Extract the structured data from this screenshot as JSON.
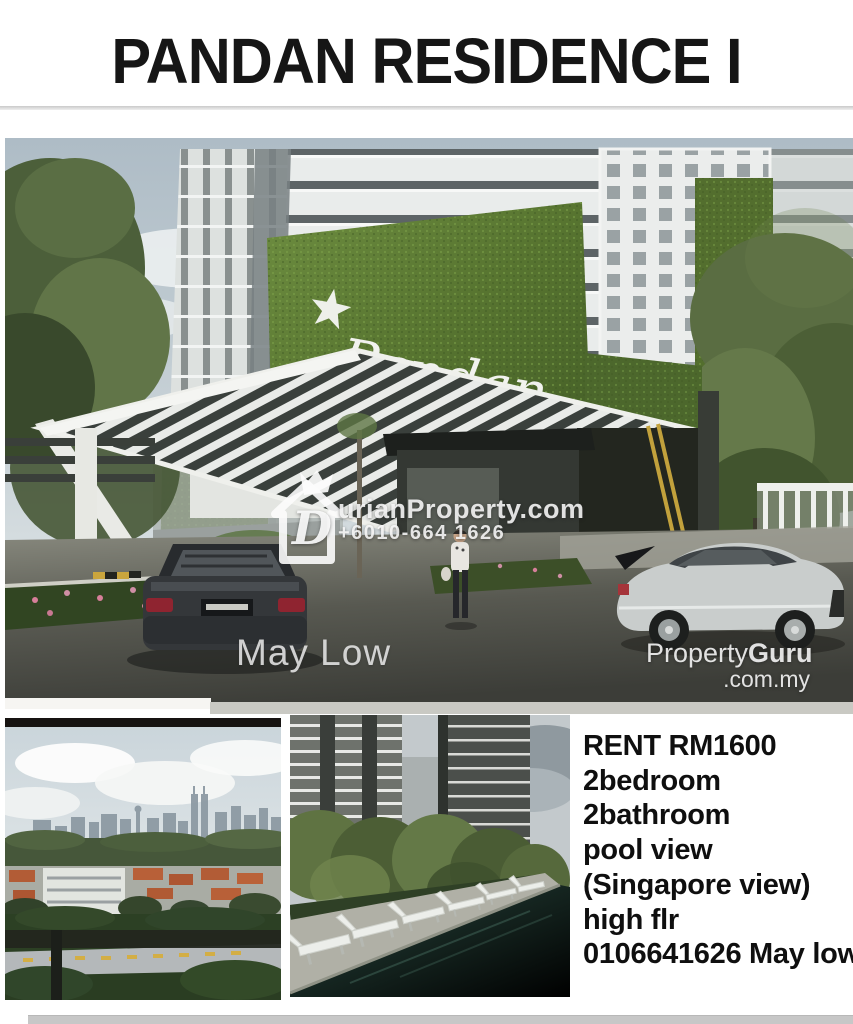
{
  "title": "PANDAN RESIDENCE I",
  "main_photo": {
    "building_sign": {
      "script": "Pandan",
      "subtitle": "RESIDENCE II"
    },
    "watermarks": {
      "durian": {
        "logo_letter": "D",
        "brand": "urianProperty.com",
        "phone": "+6010-664 1626"
      },
      "agent_name": "May Low",
      "portal": {
        "name_regular": "Property",
        "name_bold": "Guru",
        "domain": ".com.my"
      }
    }
  },
  "listing": {
    "lines": [
      "RENT RM1600",
      "2bedroom",
      "2bathroom",
      "pool view",
      "(Singapore view)",
      "high flr",
      "0106641626 May low"
    ]
  },
  "colors": {
    "grass_green": "#5a762f",
    "pool_green": "#1d3b33",
    "title_color": "#161616",
    "bottom_bar_gray": "#c7c7c7"
  }
}
